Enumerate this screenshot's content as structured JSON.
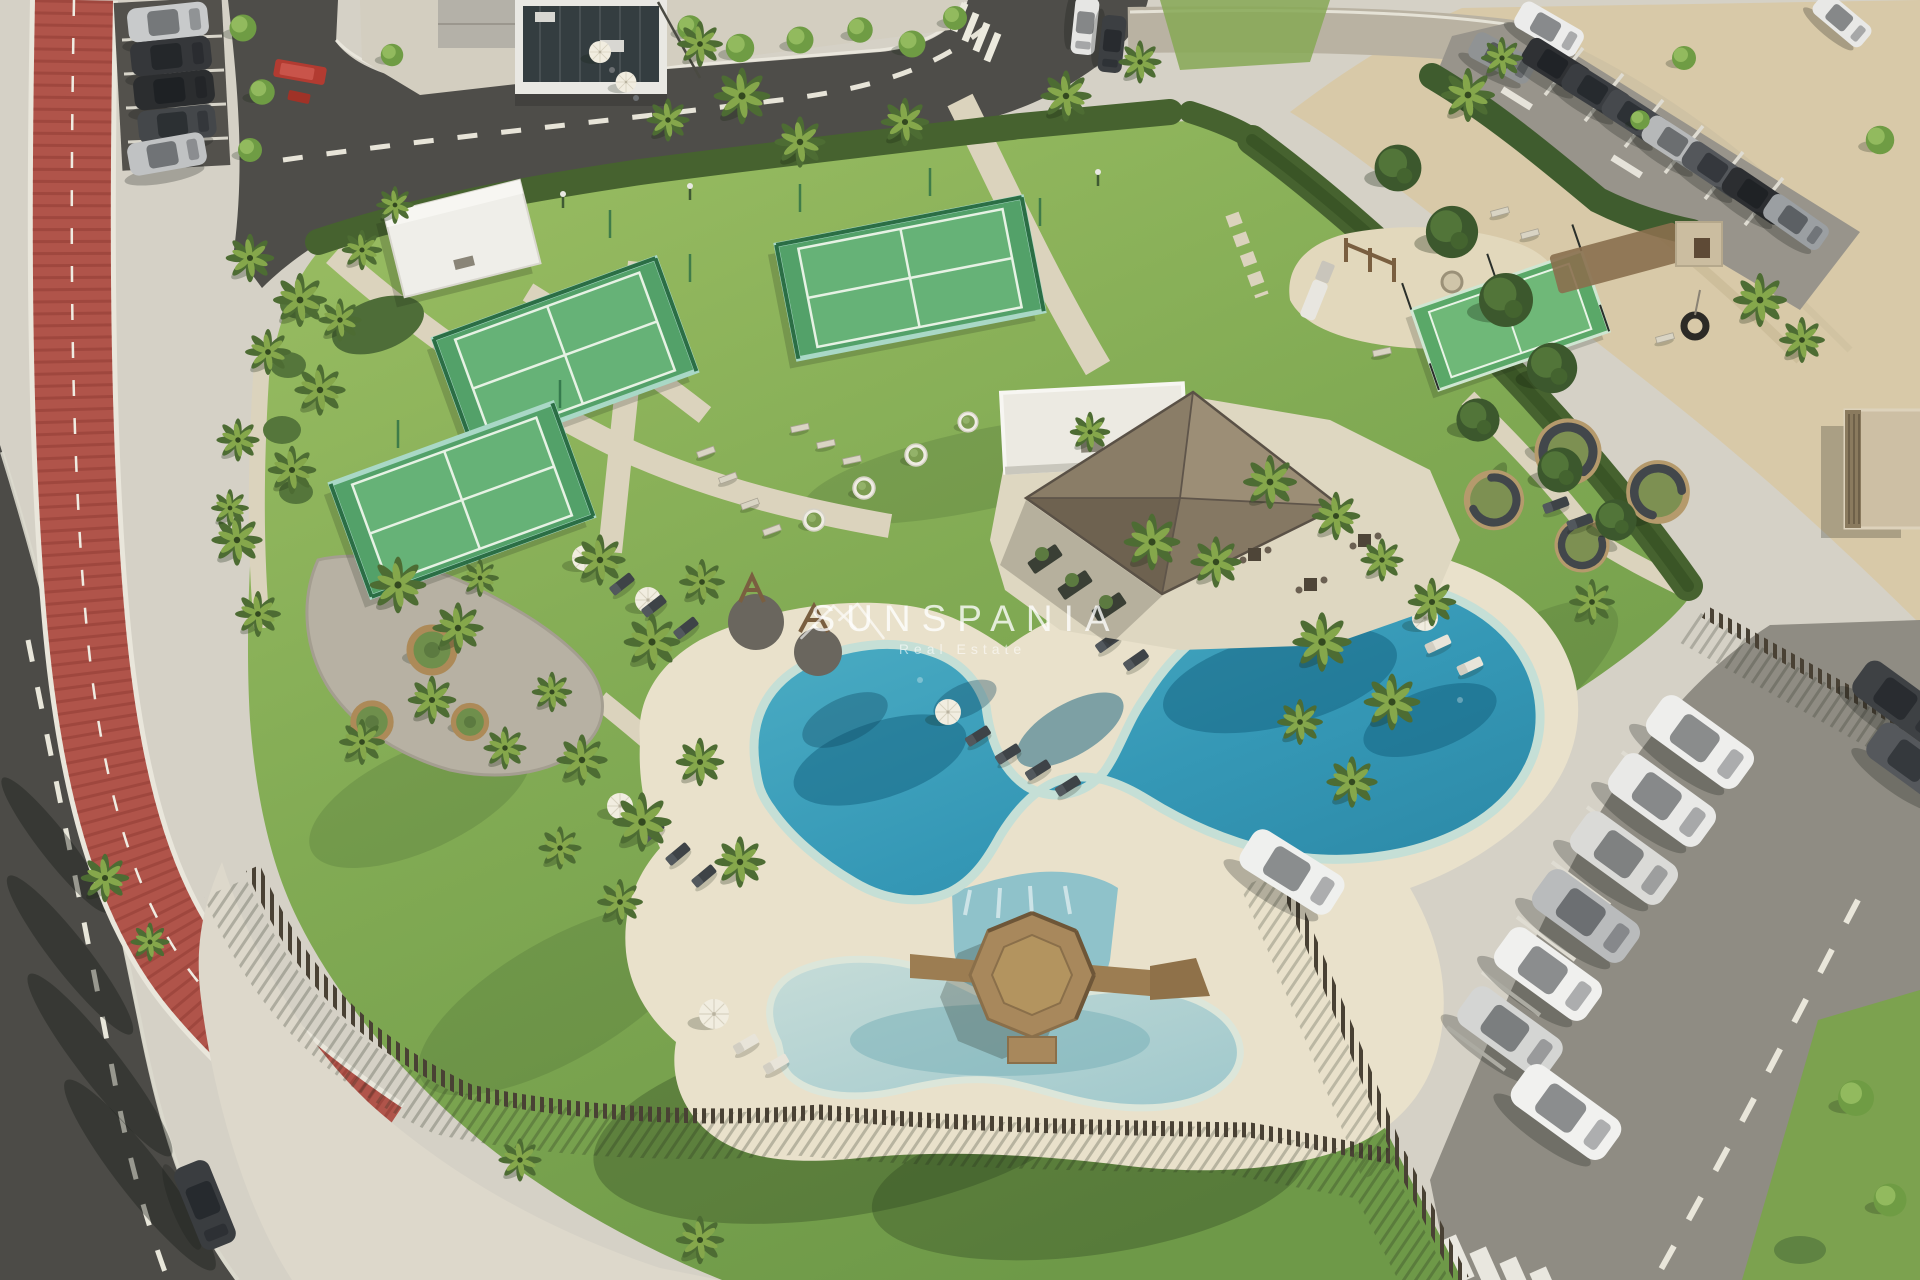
{
  "page": {
    "title": "Aerial 3D render of beachside resort amenity park"
  },
  "watermark": {
    "brand": "SUNSPANIA",
    "tagline": "Real Estate",
    "logo": "mountain-peaks-icon",
    "text_color": "#ffffff"
  },
  "scene": {
    "type": "aerial-architectural-render",
    "description": "Bird's-eye 3D visualization of a coastal residential amenity park: free-form lagoon pool with sandy beach edge, kids pool, octagonal timber island deck with bridges, three glass-walled padel courts, a multisport mini court, thatched-roof pool-bar pavilion, playground, circular privacy seating pods, palm gardens, perimeter road with red cycle lane, street parking and a beach parking lot beside sand dunes.",
    "features": [
      "curved-asphalt-road",
      "red-cycle-lane",
      "pedestrian-promenade",
      "zebra-crossing",
      "slatted-timber-fence",
      "clipped-hedges",
      "palm-trees",
      "gravel-garden",
      "octagonal-tree-benches",
      "lagoon-swimming-pool",
      "kids-pool",
      "octagonal-timber-deck",
      "timber-bridges",
      "sandy-pool-beach",
      "sun-loungers",
      "parasols",
      "padel-courts",
      "multisport-mini-court",
      "thatched-pool-bar-pavilion",
      "white-service-building",
      "children-playground",
      "tire-swing",
      "privacy-seating-pods",
      "street-parking",
      "beach-parking-lot",
      "modern-building",
      "cafe-terrace",
      "red-minibus",
      "sand-dunes"
    ],
    "palette": {
      "asphalt_dark": "#4c4b47",
      "asphalt_light": "#8f8c83",
      "cycle_lane_red": "#b0544a",
      "sidewalk": "#ddd8cb",
      "paving_base": "#d5d1c6",
      "beach_sand": "#e9e1cb",
      "dune_sand": "#d8c9a8",
      "lawn_light": "#9cbf64",
      "lawn_dark": "#6e9948",
      "hedge_green": "#46622f",
      "palm_dark": "#4d6c33",
      "palm_light": "#85a74b",
      "pool_deep": "#2a86a4",
      "pool_light": "#4fb0c6",
      "kids_pool": "#9fc8cc",
      "deck_wood": "#a8885c",
      "thatch_roof": "#8d7f6a",
      "building_white": "#e9e8e3",
      "fence_timber": "#494134",
      "court_turf": "#53a169",
      "court_frame": "#2b6e45",
      "car_white": "#eeeeec",
      "car_silver": "#b6b8b9",
      "car_dark": "#35373a",
      "minibus_red": "#b23b31",
      "road_marking": "#e9e6da"
    }
  }
}
